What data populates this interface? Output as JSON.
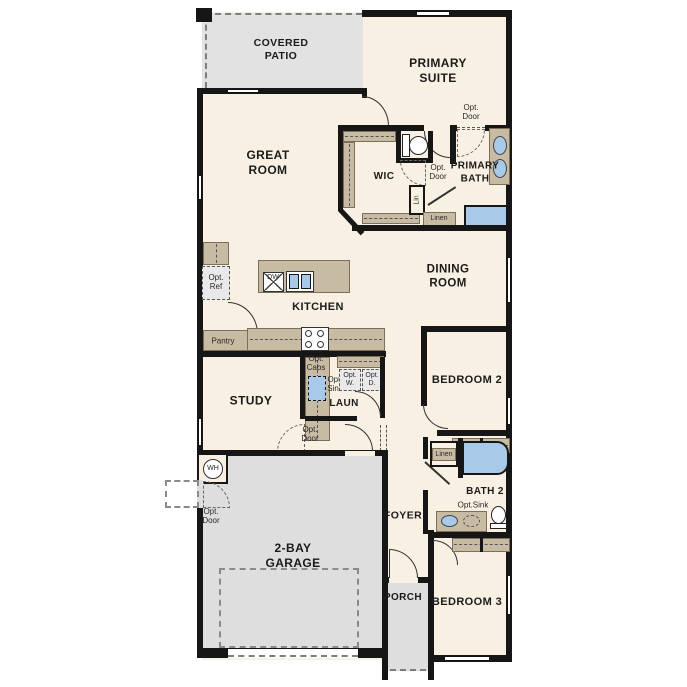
{
  "meta": {
    "type": "residential-floor-plan"
  },
  "colors": {
    "floor": "#f8f0e2",
    "patio_gray": "#e2e2e2",
    "garage_gray": "#dedede",
    "cabinet_tan": "#c8bba3",
    "fixture_blue": "#a9c9e9",
    "wall_black": "#161616"
  },
  "labels": {
    "covered_patio": "COVERED\nPATIO",
    "primary_suite": "PRIMARY\nSUITE",
    "great_room": "GREAT\nROOM",
    "wic": "WIC",
    "primary_bath": "PRIMARY\nBATH",
    "dining_room": "DINING\nROOM",
    "kitchen": "KITCHEN",
    "study": "STUDY",
    "laun": "LAUN",
    "bedroom2": "BEDROOM 2",
    "bedroom3": "BEDROOM 3",
    "bath2": "BATH 2",
    "foyer": "FOYER",
    "garage": "2-BAY\nGARAGE",
    "porch": "PORCH",
    "pantry": "Pantry",
    "linen": "Linen",
    "lin": "Lin",
    "wh": "WH",
    "dw": "DW",
    "opt_door": "Opt.\nDoor",
    "opt_ref": "Opt.\nRef",
    "opt_cabs": "Opt.\nCabs",
    "opt_sink": "Opt.\nSink",
    "opt_w": "Opt.\nW.",
    "opt_d": "Opt.\nD.",
    "opt_sink_inline": "Opt.Sink"
  }
}
